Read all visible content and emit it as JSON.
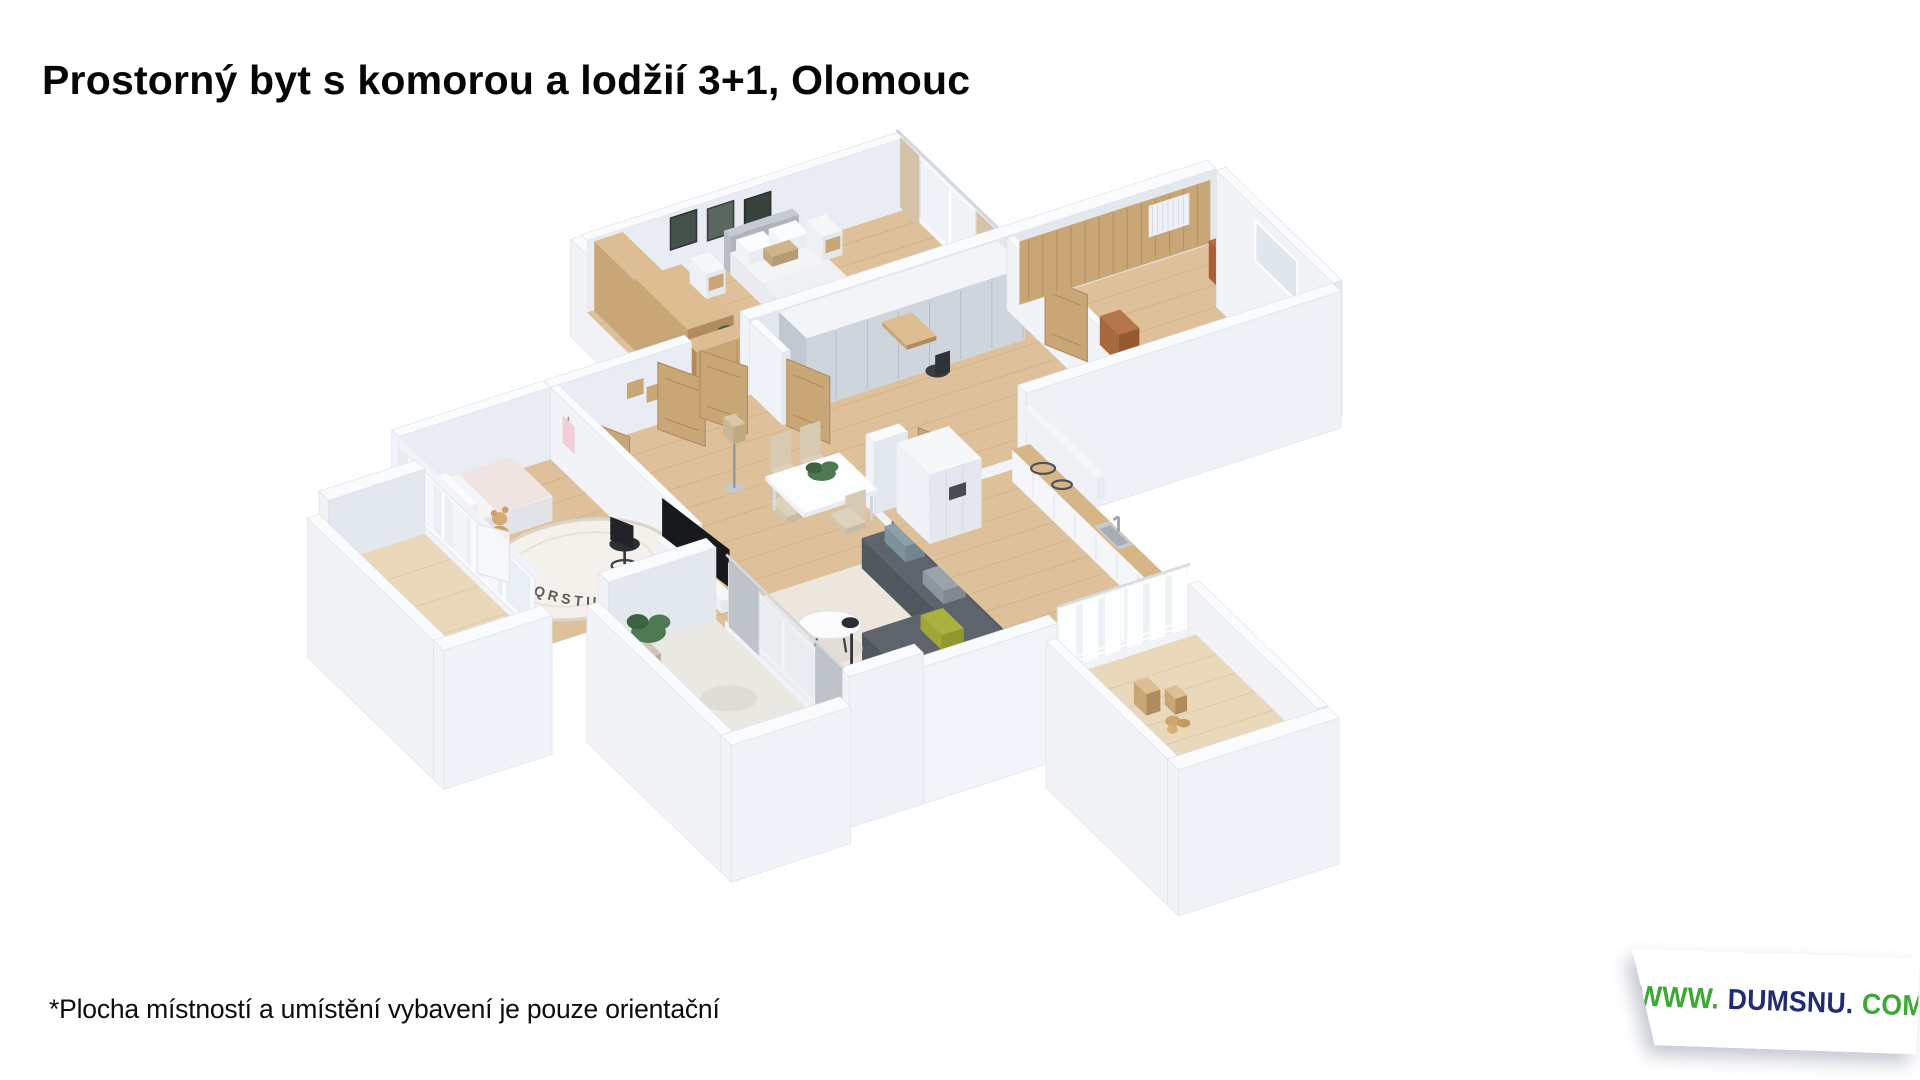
{
  "title": {
    "text": "Prostorný byt s komorou a lodžií 3+1, Olomouc"
  },
  "footnote": {
    "text": "*Plocha místností a umístění vybavení je pouze orientační"
  },
  "watermark": {
    "www": "WWW.",
    "name": "DUMSNU.",
    "com": "COM",
    "green_hex": "#3DA932",
    "navy_hex": "#222C74"
  },
  "floorplan": {
    "kind": "3D isometric apartment render",
    "rug_letters": "NOPQRSTUV",
    "colors": {
      "wall_top": "#fafbfd",
      "wall_light": "#f1f3f7",
      "wall_mid": "#e3e7ee",
      "wall_inner": "#e9edf3",
      "floor_wood": "#dec19a",
      "floor_line": "#c8a87c",
      "floor_pale": "#eae8e3",
      "balcony_wood": "#e9d9ba",
      "wood": "#c8a676",
      "wood_top": "#dcbe92",
      "wood_dark": "#b08b5e",
      "glass": "#dfe6ee",
      "curtain_beige": "#d5c2a9",
      "curtain_gray": "#bcc0c7",
      "panel": "#cfd5dd",
      "panel_dark": "#c1c8d2",
      "sofa_top": "#666d75",
      "sofa": "#565d65",
      "sofa_dark": "#4a5159",
      "tv": "#17191d",
      "accent_olive": "#aab23f",
      "plant": "#4d7a50",
      "plant_dark": "#3b6342",
      "rug": "#f4f1ec",
      "rug_edge": "#dcd5c9",
      "letters": "#5c5a56",
      "chair_beige": "#d6cab2",
      "white_furn": "#f6f7f9",
      "dark": "#2d2f32",
      "sink": "#c6cbd1",
      "pink": "#f2ccd6",
      "brown_box": "#b5764a"
    }
  }
}
